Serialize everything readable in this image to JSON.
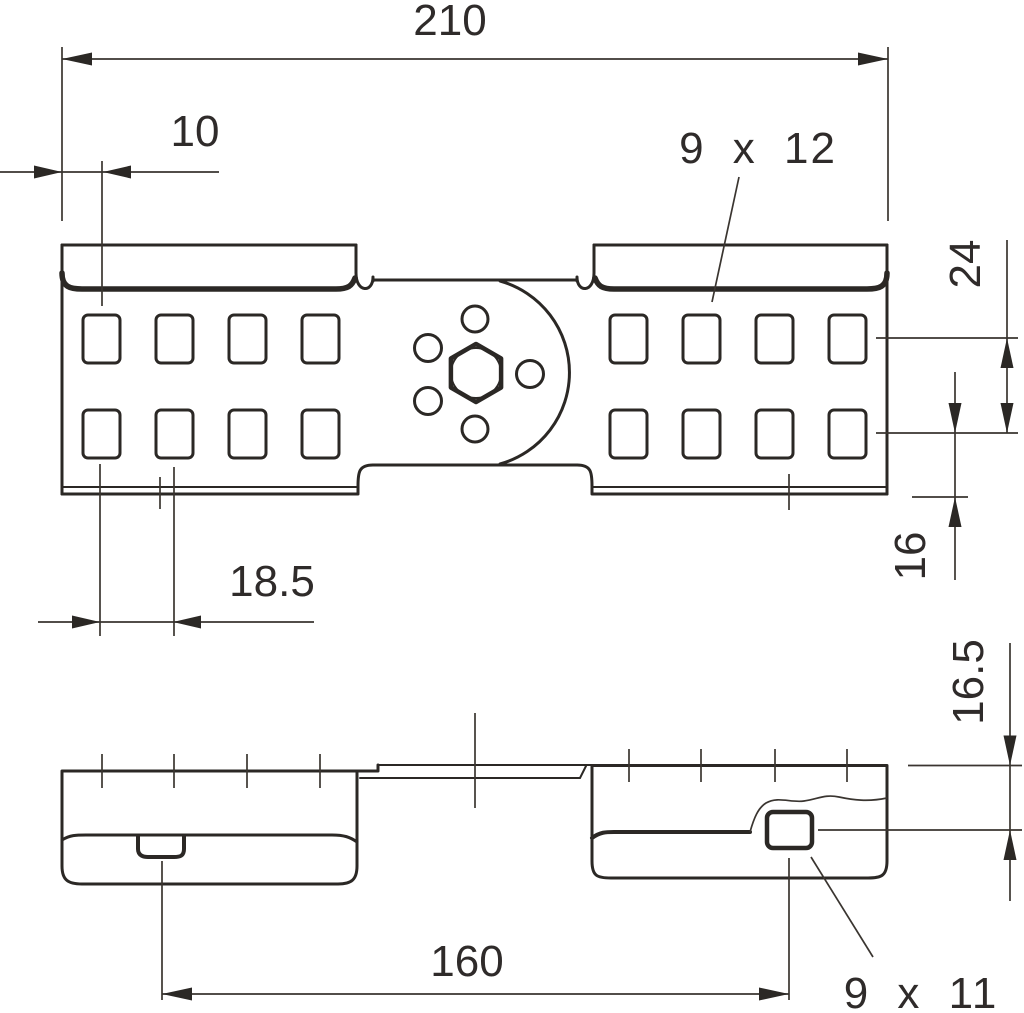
{
  "drawing": {
    "background": "#ffffff",
    "line_color": "#2b2825",
    "text_color": "#2f2b2a",
    "views": {
      "top_view": {
        "dim_overall_width": "210",
        "dim_edge_to_first_hole": "10",
        "label_slot_size": "9 x 12",
        "dim_row_spacing": "24",
        "dim_row_to_edge": "16",
        "dim_hole_pitch": "18.5"
      },
      "side_view": {
        "dim_top_to_hole_center": "16.5",
        "dim_latch_to_hole": "160",
        "label_slot_size": "9 x 11"
      }
    }
  }
}
